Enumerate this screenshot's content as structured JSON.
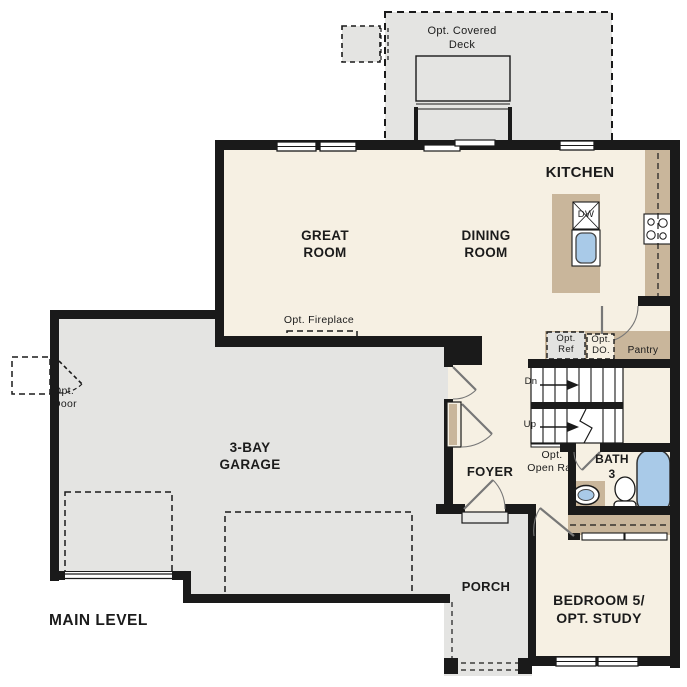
{
  "plan_title": "MAIN LEVEL",
  "colors": {
    "floor_cream": "#f6f0e3",
    "garage_gray": "#e4e4e2",
    "counter_tan": "#c9b69b",
    "fixture_blue": "#a9cae8",
    "wall_black": "#1a1a1a"
  },
  "rooms": {
    "deck": {
      "lines": [
        "Opt. Covered",
        "Deck"
      ]
    },
    "kitchen": {
      "lines": [
        "KITCHEN"
      ]
    },
    "great_room": {
      "lines": [
        "GREAT",
        "ROOM"
      ]
    },
    "dining_room": {
      "lines": [
        "DINING",
        "ROOM"
      ]
    },
    "garage": {
      "lines": [
        "3-BAY",
        "GARAGE"
      ]
    },
    "foyer": {
      "lines": [
        "FOYER"
      ]
    },
    "porch": {
      "lines": [
        "PORCH"
      ]
    },
    "bath3": {
      "lines": [
        "BATH",
        "3"
      ]
    },
    "bedroom5": {
      "lines": [
        "BEDROOM 5/",
        "OPT. STUDY"
      ]
    },
    "pantry": {
      "lines": [
        "Pantry"
      ]
    }
  },
  "annotations": {
    "opt_fireplace": {
      "lines": [
        "Opt. Fireplace"
      ]
    },
    "opt_door": {
      "lines": [
        "Opt.",
        "Door"
      ]
    },
    "opt_ref": {
      "lines": [
        "Opt.",
        "Ref"
      ]
    },
    "opt_do": {
      "lines": [
        "Opt.",
        "DO."
      ]
    },
    "opt_open_rail": {
      "lines": [
        "Opt.",
        "Open Rail"
      ]
    },
    "dishwasher": {
      "lines": [
        "DW"
      ]
    },
    "stairs_down": {
      "lines": [
        "Dn"
      ]
    },
    "stairs_up": {
      "lines": [
        "Up"
      ]
    },
    "main_level": {
      "lines": [
        "MAIN LEVEL"
      ]
    }
  }
}
